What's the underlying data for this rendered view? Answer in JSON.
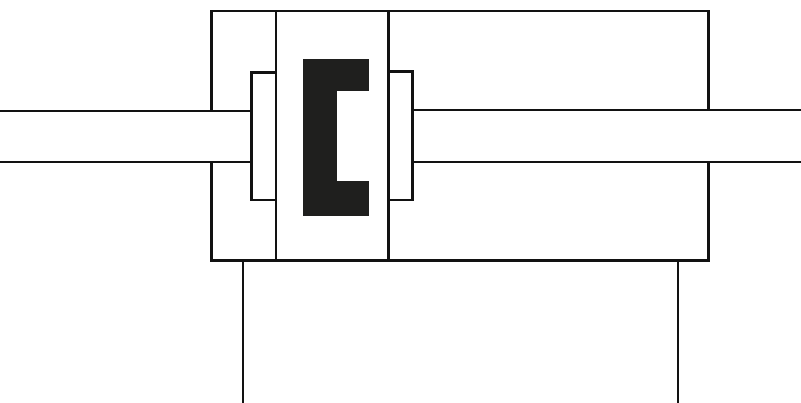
{
  "diagram": {
    "kind": "pneumatic-cylinder-cross-section",
    "canvas": {
      "width": 801,
      "height": 403,
      "background": "#ffffff"
    },
    "colors": {
      "line": "#121212",
      "seal": "#1f1f1e"
    },
    "shapes": [
      {
        "name": "cylinder-body-top-wall",
        "x": 210,
        "y": 9.8,
        "w": 500,
        "h": 2.5,
        "color": "line"
      },
      {
        "name": "cylinder-body-left-wall-upper",
        "x": 210,
        "y": 9.8,
        "w": 2.5,
        "h": 101.7,
        "color": "line"
      },
      {
        "name": "cylinder-body-left-wall-lower",
        "x": 210,
        "y": 160.8,
        "w": 2.5,
        "h": 101.2,
        "color": "line"
      },
      {
        "name": "cylinder-body-right-wall-upper",
        "x": 707.3,
        "y": 9.8,
        "w": 2.5,
        "h": 101.7,
        "color": "line"
      },
      {
        "name": "cylinder-body-right-wall-lower",
        "x": 707.3,
        "y": 160.8,
        "w": 2.5,
        "h": 101.2,
        "color": "line"
      },
      {
        "name": "cylinder-body-bottom-wall",
        "x": 210,
        "y": 259.3,
        "w": 499.8,
        "h": 3,
        "color": "line"
      },
      {
        "name": "piston-left-face-line",
        "x": 274.5,
        "y": 9.8,
        "w": 2.5,
        "h": 252.5,
        "color": "line"
      },
      {
        "name": "piston-right-face-line",
        "x": 387.3,
        "y": 9.8,
        "w": 2.5,
        "h": 252.5,
        "color": "line"
      },
      {
        "name": "left-bushing-top-edge",
        "x": 250,
        "y": 71,
        "w": 27,
        "h": 2.5,
        "color": "line"
      },
      {
        "name": "left-bushing-left-edge",
        "x": 250,
        "y": 71,
        "w": 2.5,
        "h": 130,
        "color": "line"
      },
      {
        "name": "left-bushing-bottom-edge",
        "x": 250,
        "y": 198.5,
        "w": 27,
        "h": 2.5,
        "color": "line"
      },
      {
        "name": "right-bushing-top-edge",
        "x": 387.3,
        "y": 70,
        "w": 26.2,
        "h": 2.5,
        "color": "line"
      },
      {
        "name": "right-bushing-right-edge",
        "x": 411,
        "y": 70,
        "w": 2.5,
        "h": 131,
        "color": "line"
      },
      {
        "name": "right-bushing-bottom-edge",
        "x": 387.3,
        "y": 198.5,
        "w": 26.2,
        "h": 2.5,
        "color": "line"
      },
      {
        "name": "left-piston-rod-top-line",
        "x": 0,
        "y": 109.5,
        "w": 252.5,
        "h": 2.2,
        "color": "line"
      },
      {
        "name": "left-piston-rod-bottom-line",
        "x": 0,
        "y": 160.8,
        "w": 252.5,
        "h": 2.2,
        "color": "line"
      },
      {
        "name": "right-piston-rod-top-line",
        "x": 411,
        "y": 109.2,
        "w": 390,
        "h": 2.2,
        "color": "line"
      },
      {
        "name": "right-piston-rod-bottom-line",
        "x": 411,
        "y": 160.8,
        "w": 390,
        "h": 2.2,
        "color": "line"
      },
      {
        "name": "piston-cup-seal-vertical-bar",
        "x": 302.5,
        "y": 59,
        "w": 34,
        "h": 157,
        "color": "seal"
      },
      {
        "name": "piston-cup-seal-top-arm",
        "x": 336.5,
        "y": 59,
        "w": 32,
        "h": 32,
        "color": "seal"
      },
      {
        "name": "piston-cup-seal-bottom-arm",
        "x": 336.5,
        "y": 180.5,
        "w": 32,
        "h": 35.5,
        "color": "seal"
      },
      {
        "name": "left-mounting-line",
        "x": 242,
        "y": 261.5,
        "w": 2.3,
        "h": 141.5,
        "color": "line"
      },
      {
        "name": "right-mounting-line",
        "x": 676.5,
        "y": 261.5,
        "w": 2.3,
        "h": 141.5,
        "color": "line"
      }
    ]
  }
}
